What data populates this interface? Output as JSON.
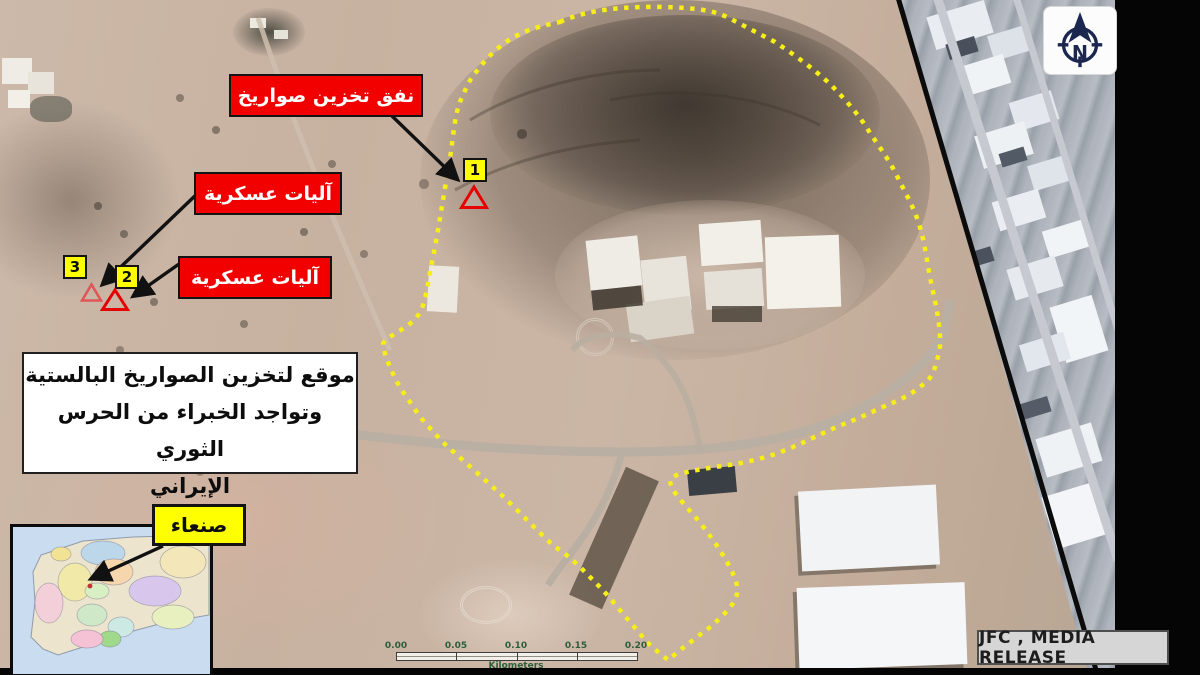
{
  "slide": {
    "annotations": {
      "tunnel_label": "نفق تخزين صواريخ",
      "vehicles_label_1": "آليات عسكرية",
      "vehicles_label_2": "آليات عسكرية",
      "site_box": {
        "line1": "موقع لتخزين الصواريخ البالستية",
        "line2": "وتواجد الخبراء من الحرس الثوري",
        "line3": "الإيراني"
      },
      "city_label": "صنعاء",
      "credit": "JFC , MEDIA RELEASE"
    },
    "markers": {
      "m1": "1",
      "m2": "2",
      "m3": "3"
    },
    "compass": {
      "north": "N"
    },
    "scale_bar": {
      "ticks": [
        "0.00",
        "0.05",
        "0.10",
        "0.15",
        "0.20"
      ],
      "unit": "Kilometers"
    },
    "colors": {
      "label_red": "#f20000",
      "marker_yellow": "#ffff00",
      "boundary_yellow": "#f6ee16",
      "compass_navy": "#1c2750"
    }
  }
}
